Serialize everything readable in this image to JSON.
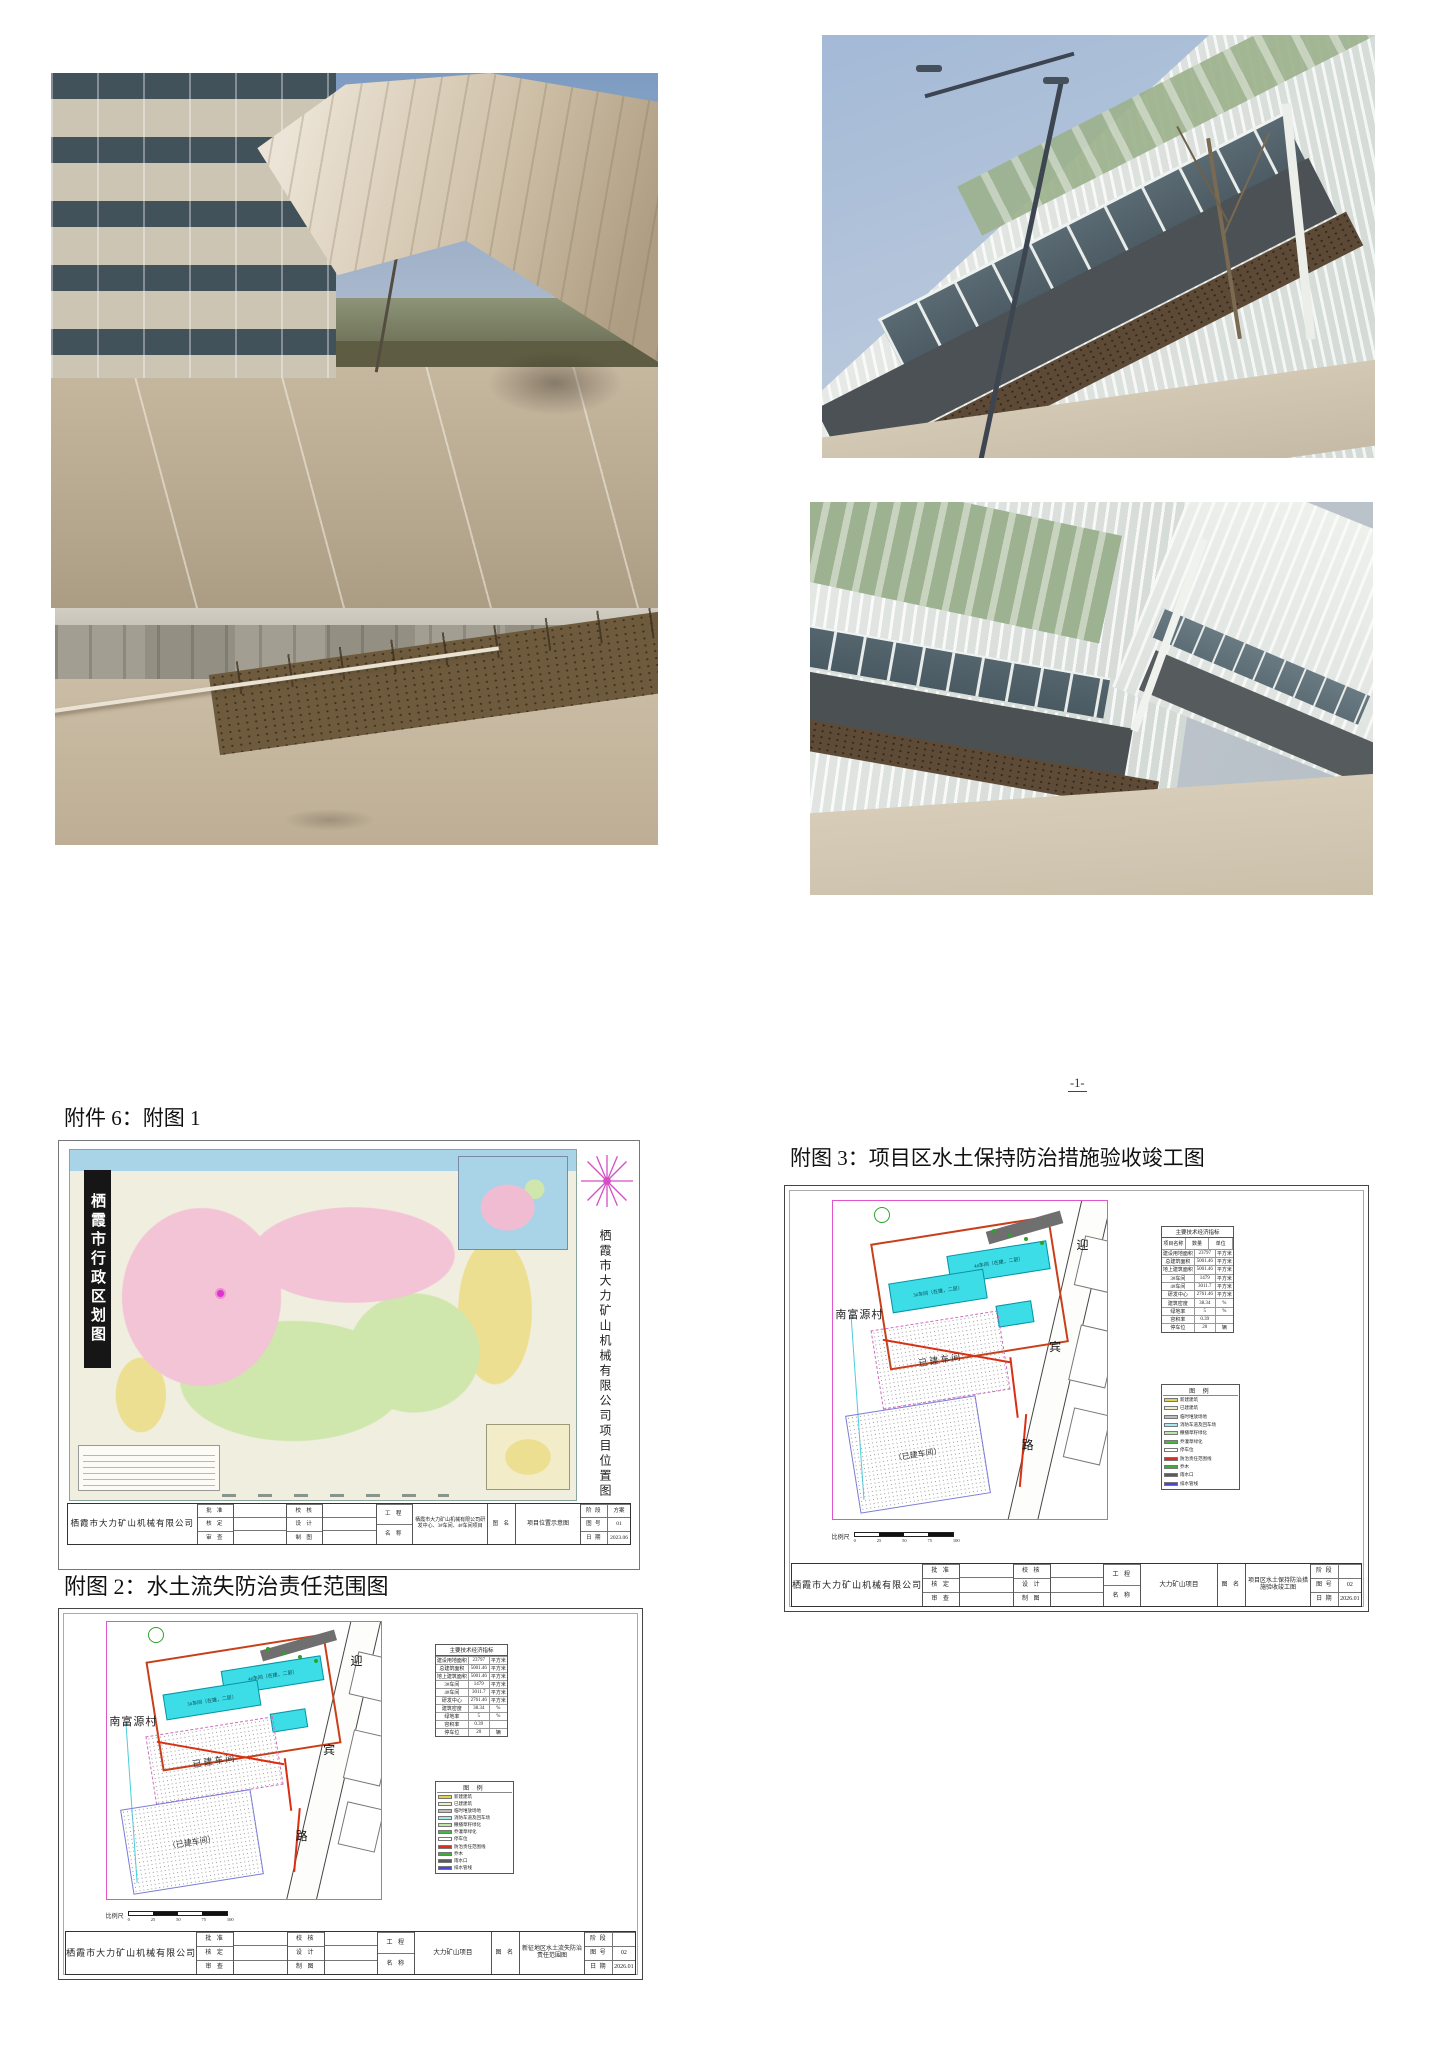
{
  "page": {
    "number": "-1-"
  },
  "sections": {
    "attachment6_heading": "附件 6：附图 1",
    "figure3_heading": "附图 3：项目区水土保持防治措施验收竣工图",
    "figure2_heading": "附图 2：水土流失防治责任范围图"
  },
  "map_figure": {
    "banner_title": "栖霞市行政区划图",
    "side_title": "栖霞市大力矿山机械有限公司项目位置图",
    "titleblock": {
      "company": "栖霞市大力矿山机械有限公司",
      "approve": [
        "批 准",
        "核 定",
        "审 查"
      ],
      "check": [
        "校 核",
        "设 计",
        "制 图"
      ],
      "project_label": [
        "工 程",
        "名 称"
      ],
      "project_value": "栖霞市大力矿山机械有限公司研发中心、3#车间、4#车间项目",
      "figname_label": "图 名",
      "figname_value": "项目位置示意图",
      "meta": [
        {
          "label": "阶 段",
          "value": "方案"
        },
        {
          "label": "图 号",
          "value": "01"
        },
        {
          "label": "日 期",
          "value": "2023.06"
        }
      ]
    }
  },
  "drawing3": {
    "plan": {
      "village": "南富源村",
      "road_chars": [
        "迎",
        "宾",
        "路"
      ],
      "building_top_label": "4#车间（在建，二层）",
      "building_mid_label": "3#车间（在建，二层）",
      "area1_label": "已建车间",
      "area2_label": "（已建车间）"
    },
    "tech_table": {
      "title": "主要技术经济指标",
      "headers": [
        "项目名称",
        "数量",
        "单位"
      ],
      "rows": [
        [
          "建设用地面积",
          "23797",
          "平方米"
        ],
        [
          "总建筑面积",
          "5001.46",
          "平方米"
        ],
        [
          "地上建筑面积",
          "5001.46",
          "平方米"
        ],
        [
          "3#车间",
          "1479",
          "平方米"
        ],
        [
          "4#车间",
          "3011.7",
          "平方米"
        ],
        [
          "研发中心",
          "2761.46",
          "平方米"
        ],
        [
          "建筑密度",
          "38.34",
          "%"
        ],
        [
          "绿地率",
          "5",
          "%"
        ],
        [
          "容积率",
          "0.39",
          ""
        ],
        [
          "停车位",
          "20",
          "辆"
        ]
      ]
    },
    "legend": {
      "title": "图 例",
      "rows": [
        {
          "color": "#e6d24a",
          "label": "新建建筑"
        },
        {
          "color": "#f2ecca",
          "label": "已建建筑"
        },
        {
          "color": "#bdbdbd",
          "label": "临时堆放场地"
        },
        {
          "color": "#a5e9f2",
          "label": "消防车道及回车场"
        },
        {
          "color": "#bfe6a8",
          "label": "撒播草籽绿化"
        },
        {
          "color": "#46b73e",
          "label": "乔灌草绿化"
        },
        {
          "color": "#ffffff",
          "label": "停车位"
        },
        {
          "color": "#e02a1a",
          "label": "防治责任范围线"
        },
        {
          "color": "#3fae37",
          "label": "乔木"
        },
        {
          "color": "#5a5a5a",
          "label": "雨水口"
        },
        {
          "color": "#4446e0",
          "label": "排水管线"
        }
      ]
    },
    "scalebar": {
      "label": "比例尺",
      "ticks": [
        "0",
        "25",
        "50",
        "75",
        "100"
      ]
    },
    "titleblock": {
      "company": "栖霞市大力矿山机械有限公司",
      "approve": [
        "批 准",
        "核 定",
        "审 查"
      ],
      "check": [
        "校 核",
        "设 计",
        "制 图"
      ],
      "project_label": [
        "工 程",
        "名 称"
      ],
      "project_value": "大力矿山项目",
      "figname_label": "图 名",
      "figname_value": "项目区水土保持防治措施验收竣工图",
      "meta": [
        {
          "label": "阶 段",
          "value": ""
        },
        {
          "label": "图 号",
          "value": "02"
        },
        {
          "label": "日 期",
          "value": "2026.01"
        }
      ]
    }
  },
  "drawing2": {
    "plan": {
      "village": "南富源村",
      "road_chars": [
        "迎",
        "宾",
        "路"
      ],
      "building_top_label": "4#车间（在建，二层）",
      "building_mid_label": "3#车间（在建，二层）",
      "area1_label": "已建车间",
      "area2_label": "（已建车间）"
    },
    "tech_table": {
      "title": "主要技术经济指标",
      "headers": [
        "项目名称",
        "数量",
        "单位"
      ],
      "rows": [
        [
          "建设用地面积",
          "23797",
          "平方米"
        ],
        [
          "总建筑面积",
          "5001.46",
          "平方米"
        ],
        [
          "地上建筑面积",
          "5001.46",
          "平方米"
        ],
        [
          "3#车间",
          "1479",
          "平方米"
        ],
        [
          "4#车间",
          "3011.7",
          "平方米"
        ],
        [
          "研发中心",
          "2761.46",
          "平方米"
        ],
        [
          "建筑密度",
          "38.34",
          "%"
        ],
        [
          "绿地率",
          "5",
          "%"
        ],
        [
          "容积率",
          "0.39",
          ""
        ],
        [
          "停车位",
          "20",
          "辆"
        ]
      ]
    },
    "legend": {
      "title": "图 例",
      "rows": [
        {
          "color": "#e6d24a",
          "label": "新建建筑"
        },
        {
          "color": "#f2ecca",
          "label": "已建建筑"
        },
        {
          "color": "#bdbdbd",
          "label": "临时堆放场地"
        },
        {
          "color": "#a5e9f2",
          "label": "消防车道及回车场"
        },
        {
          "color": "#bfe6a8",
          "label": "撒播草籽绿化"
        },
        {
          "color": "#46b73e",
          "label": "乔灌草绿化"
        },
        {
          "color": "#ffffff",
          "label": "停车位"
        },
        {
          "color": "#e02a1a",
          "label": "防治责任范围线"
        },
        {
          "color": "#3fae37",
          "label": "乔木"
        },
        {
          "color": "#5a5a5a",
          "label": "雨水口"
        },
        {
          "color": "#4446e0",
          "label": "排水管线"
        }
      ]
    },
    "scalebar": {
      "label": "比例尺",
      "ticks": [
        "0",
        "25",
        "50",
        "75",
        "100"
      ]
    },
    "titleblock": {
      "company": "栖霞市大力矿山机械有限公司",
      "approve": [
        "批 准",
        "核 定",
        "审 查"
      ],
      "check": [
        "校 核",
        "设 计",
        "制 图"
      ],
      "project_label": [
        "工 程",
        "名 称"
      ],
      "project_value": "大力矿山项目",
      "figname_label": "图 名",
      "figname_value": "新征地区水土流失防治责任范围图",
      "meta": [
        {
          "label": "阶 段",
          "value": ""
        },
        {
          "label": "图 号",
          "value": "02"
        },
        {
          "label": "日 期",
          "value": "2026.01"
        }
      ]
    }
  }
}
